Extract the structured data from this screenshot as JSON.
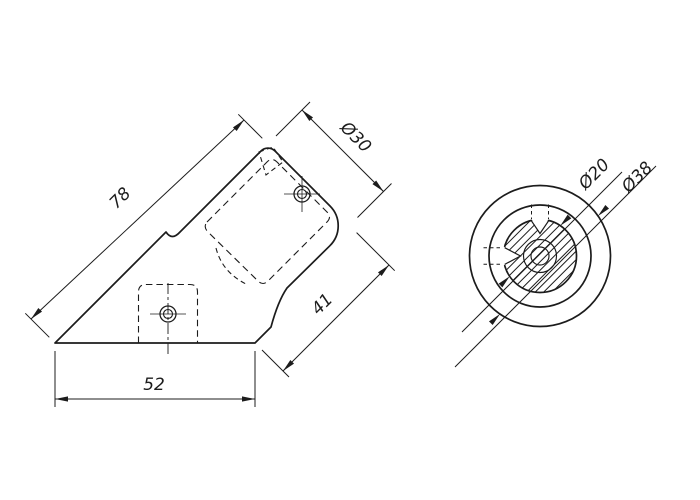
{
  "page": {
    "background": "#ffffff",
    "ink": "#1c1c1c"
  },
  "views": {
    "side": {
      "title": "side-view-of-angled-tube-connector",
      "dims": {
        "length": "78",
        "tube_dia": "Ø30",
        "arm": "41",
        "base": "52"
      }
    },
    "end": {
      "title": "end-view-of-connector",
      "dims": {
        "core_dia": "Ø20",
        "outer_dia": "Ø38"
      }
    }
  }
}
